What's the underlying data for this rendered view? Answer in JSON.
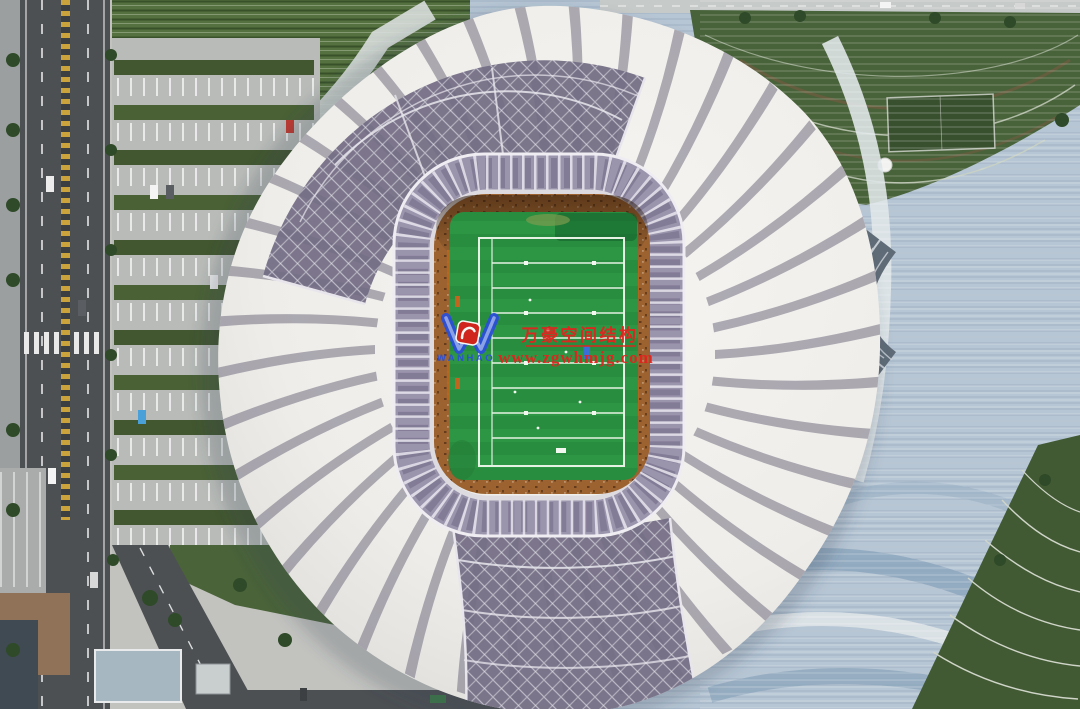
{
  "image": {
    "kind": "aerial-drone-photograph",
    "subject": "stadium with swirling white petal roof, green football field at center, parking lot and road at left, wave-patterned plaza and lawns at right",
    "colors": {
      "roof_white": "#f0eeea",
      "roof_lattice": "#746d85",
      "ring_band": "#9b94ad",
      "stands_brown": "#9c6331",
      "field_green": "#2d9644",
      "plaza_blue_gray": "#b7c6d4",
      "lawn_green": "#48623a",
      "road_gray": "#4c5053",
      "watermark_red": "#e3231e",
      "watermark_blue": "#2b4fd8"
    }
  },
  "watermark": {
    "logo_text": "WANHAO",
    "company": "万豪空间结构",
    "website": "www.zgwhmjg.com"
  }
}
